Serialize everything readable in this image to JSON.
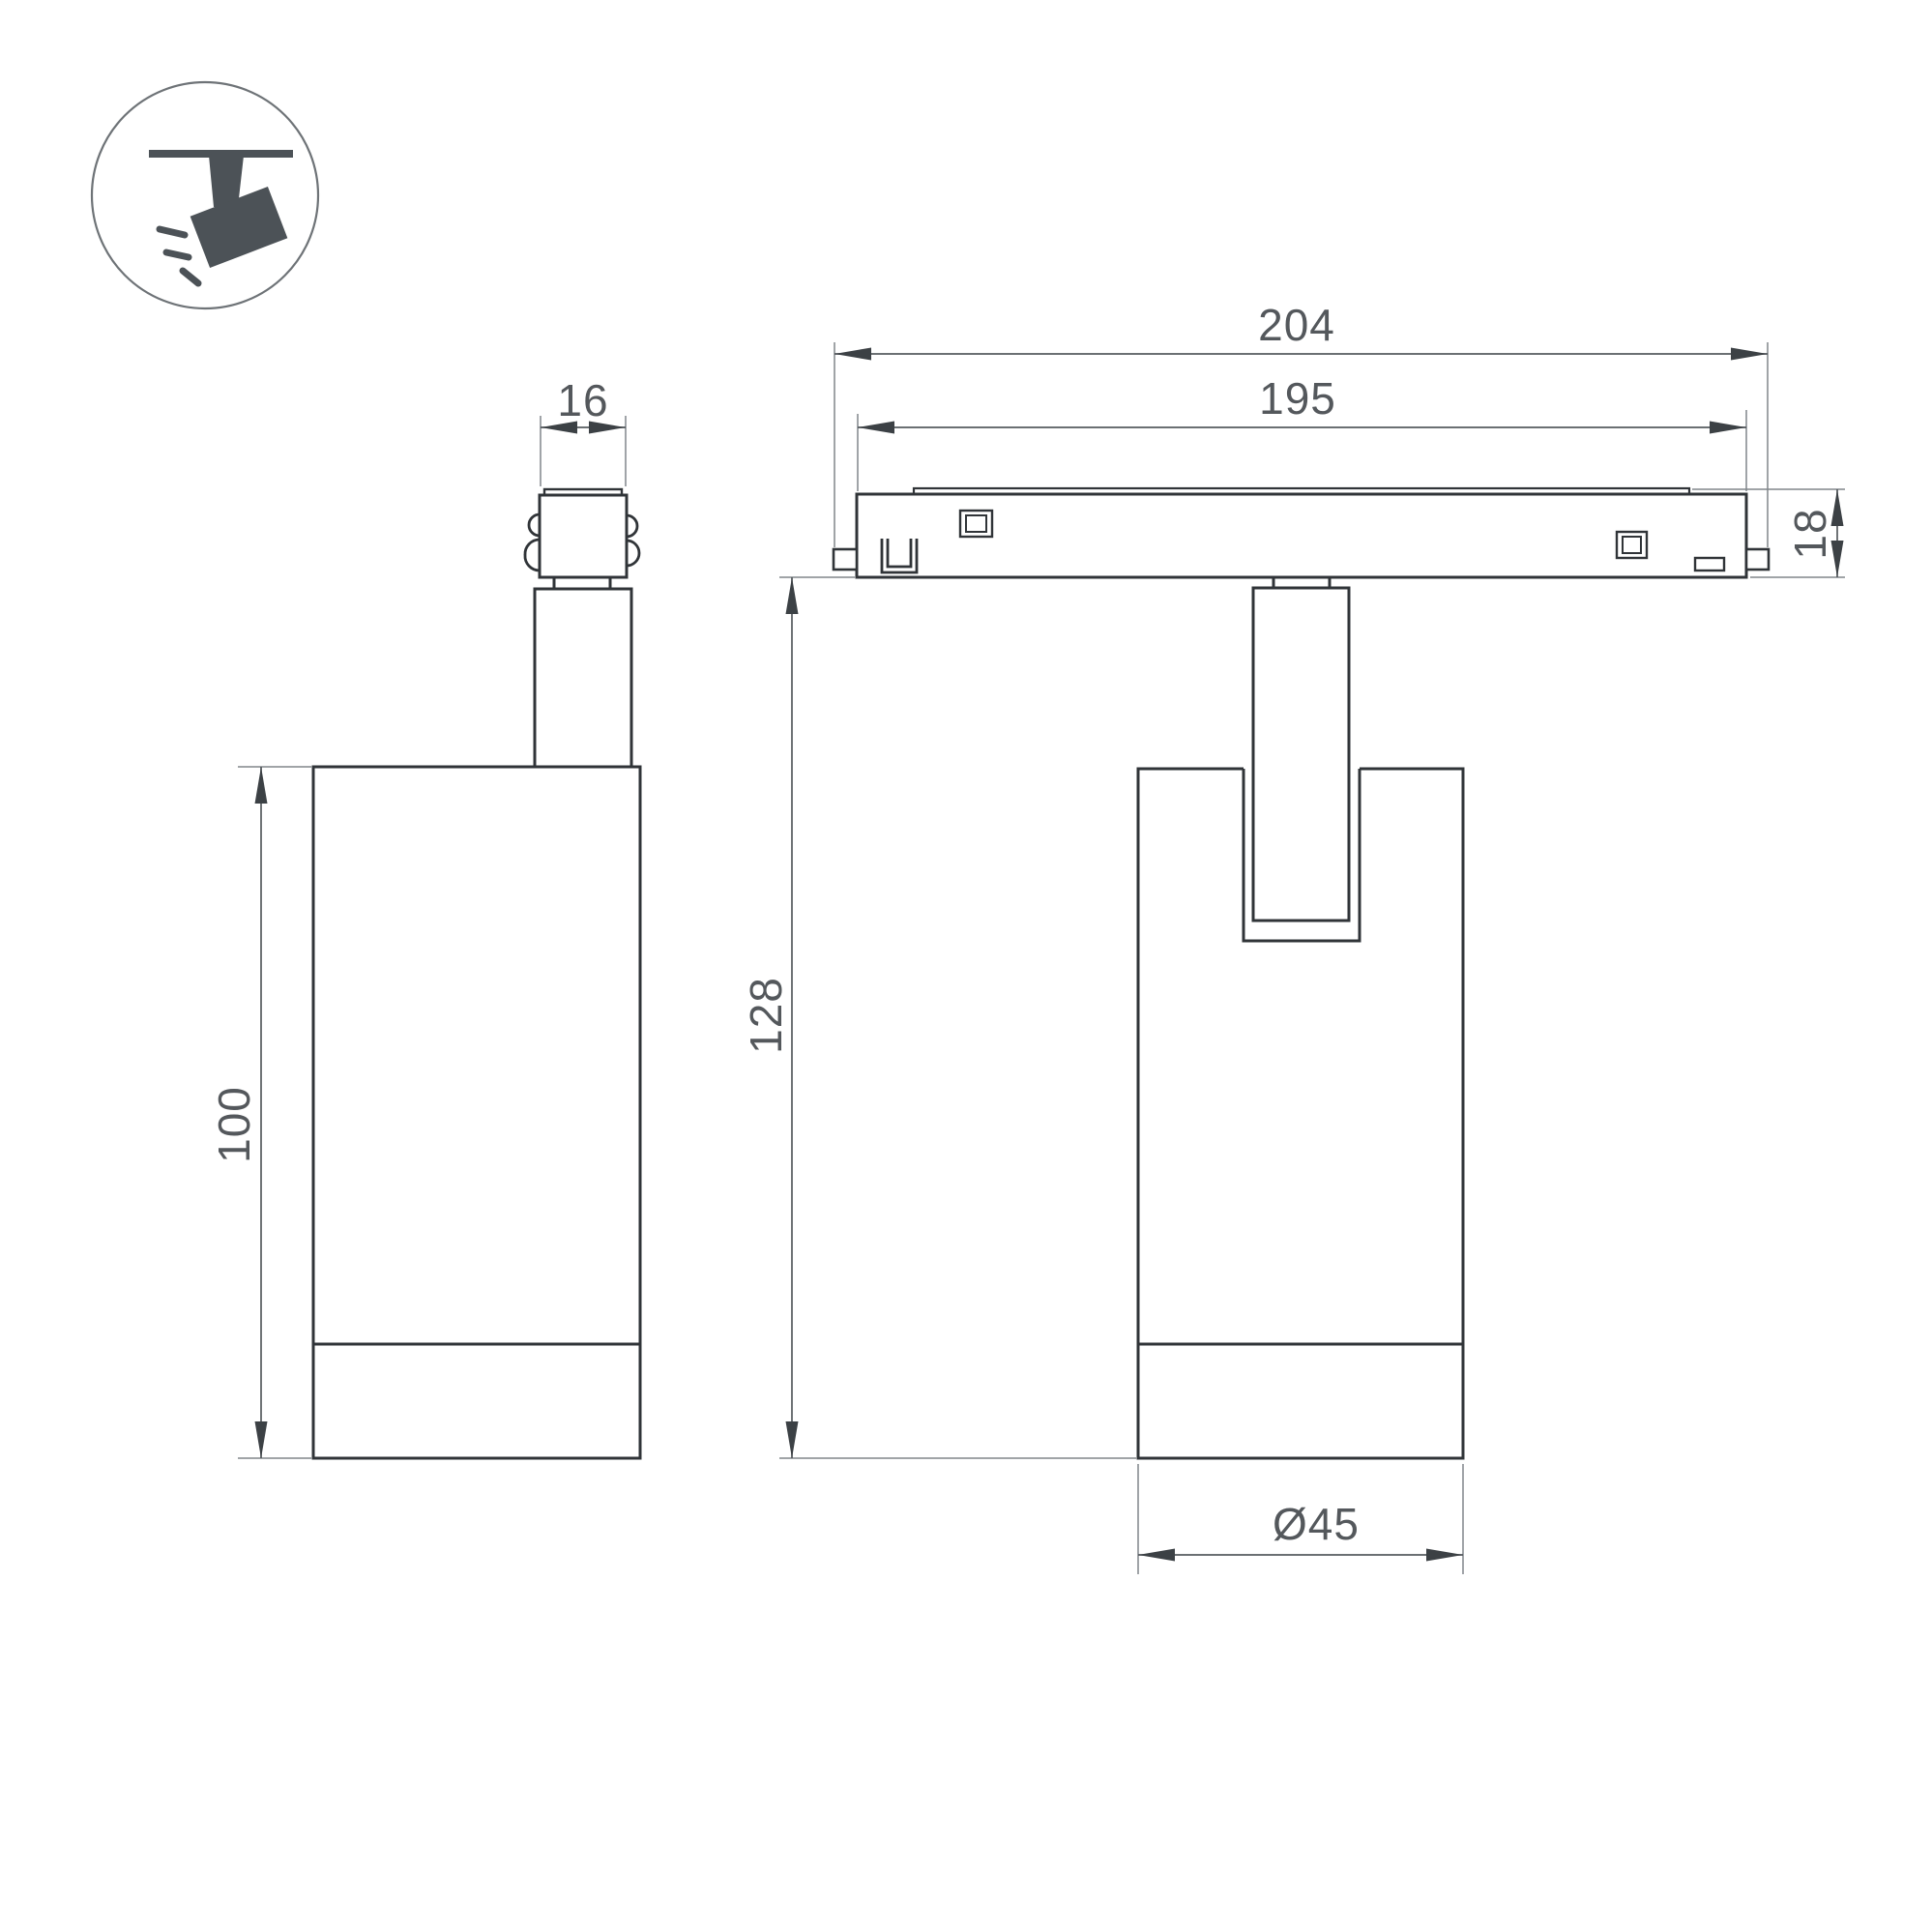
{
  "drawing_type": "technical-dimension-drawing",
  "product": "track-mounted-spotlight",
  "colors": {
    "background": "#ffffff",
    "line": "#303438",
    "dim": "#565b5f",
    "ext": "#80868a",
    "arrow": "#3c4145",
    "text": "#54585c",
    "icon": "#4c5257",
    "icon_ring": "#6e7377"
  },
  "dims": {
    "adapter_width": "16",
    "track_outer": "204",
    "track_inner": "195",
    "track_height": "18",
    "body_height": "100",
    "overall_height": "128",
    "body_diameter": "Ø45"
  }
}
